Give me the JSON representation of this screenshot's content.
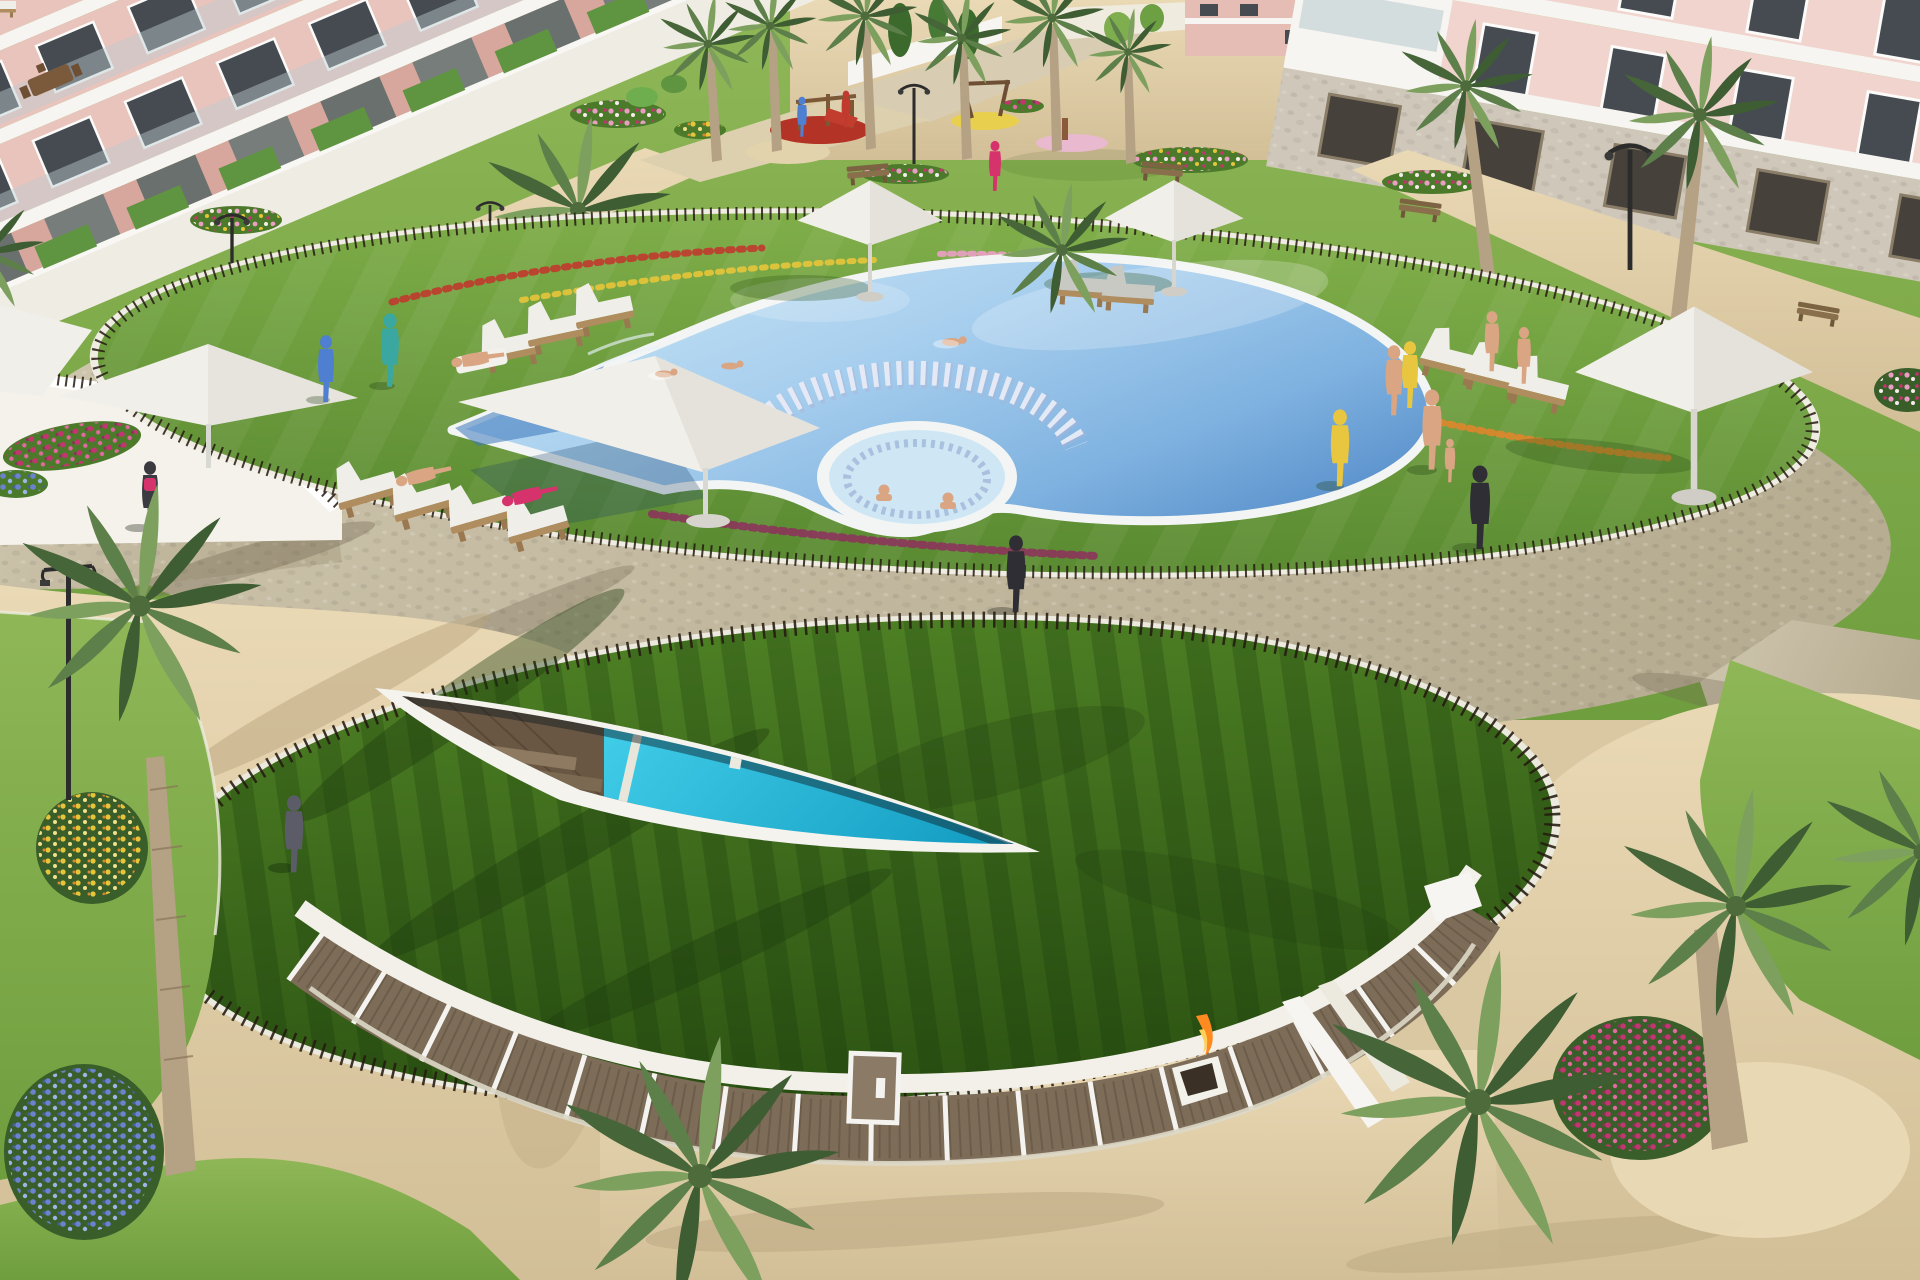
{
  "scene": {
    "type": "photorealistic aerial 3D rendering",
    "setting": "Aerial render of a resort-style residential complex: circular landscaped pool deck with lagoon pool and jacuzzi, lower green-roof clubhouse with lens skylight over an indoor pool, pink apartment blocks, palm trees, flower beds and sandy plazas",
    "objects": [
      "apartment-building-left",
      "apartment-building-right",
      "communal-garden",
      "playground",
      "main-pool",
      "jacuzzi",
      "in-pool-bench-arc",
      "shade-platform",
      "sun-umbrellas",
      "sun-loungers",
      "spike-fence",
      "stone-walkway",
      "green-roof",
      "indoor-pool-skylight",
      "clubhouse-glass-facade",
      "fire-feature",
      "palm-trees",
      "flower-beds",
      "sand-plaza",
      "residents"
    ]
  },
  "counts": {
    "sun_umbrellas": 6,
    "shade_platforms": 2,
    "sun_loungers": 16,
    "people_visible": 28,
    "foreground_palm_crowns": 5,
    "playground_mats": 3
  },
  "colors": {
    "sand": "#d9c8a2",
    "sand_light": "#ead9b5",
    "sand_shadow": "#b9a67f",
    "stone": "#c8bfa6",
    "stone_dark": "#b2a98e",
    "grass_garden": "#7ca845",
    "grass_garden_dark": "#5f8c32",
    "grass_deck": "#6fa03c",
    "grass_deck_dark": "#557f2c",
    "grass_roof": "#3f7020",
    "grass_roof_dark": "#2c5215",
    "shadow_green": "#1e3c10",
    "pool_light": "#cfe9f7",
    "pool_mid": "#9cc8ea",
    "pool_deep": "#6fa6d8",
    "pool_corner": "#3c77bb",
    "rim_white": "#f3f5f4",
    "jacuzzi": "#cfe7f4",
    "indoor_pool": "#2dc3e2",
    "indoor_pool_deep": "#169fc4",
    "wood_deck": "#6a5743",
    "wood_step": "#8d7a60",
    "fence": "#241a10",
    "white": "#f6f5f1",
    "canopy": "#f1efe9",
    "canopy_shade": "#d9d6cd",
    "bldg_pink": "#e9c4bc",
    "bldg_pink_dark": "#f0d4cd",
    "bldg_pier": "#d7a79e",
    "bldg_stone": "#cfc7b9",
    "window_glass": "#464b51",
    "frame_white": "#fbfbfa",
    "balcony_glass": "#bccdd1",
    "hedge": "#5f9440",
    "club_glass": "#7d6c58",
    "club_glass_dark": "#473a2c",
    "mullion": "#f4f3ef",
    "palm_dark": "#3e5d33",
    "palm_mid": "#5d7f4a",
    "palm_light": "#7da05f",
    "trunk": "#b5a184",
    "flower_magenta": "#c2356f",
    "flower_pink": "#ea9ec4",
    "flower_white": "#f2efe9",
    "flower_yellow": "#e7c53a",
    "flower_blue": "#6b83cf",
    "flower_purple": "#a77cc9",
    "flower_red": "#c03a2e",
    "flower_orange": "#e0862c",
    "lamp_metal": "#2c2c2c",
    "bench_wood": "#8a6f4d",
    "lounger_wood": "#b08d5f",
    "cushion": "#efeee9",
    "cushion_gray": "#c9c9c4",
    "fire": "#ff8a1f",
    "skin": "#d9a583"
  }
}
